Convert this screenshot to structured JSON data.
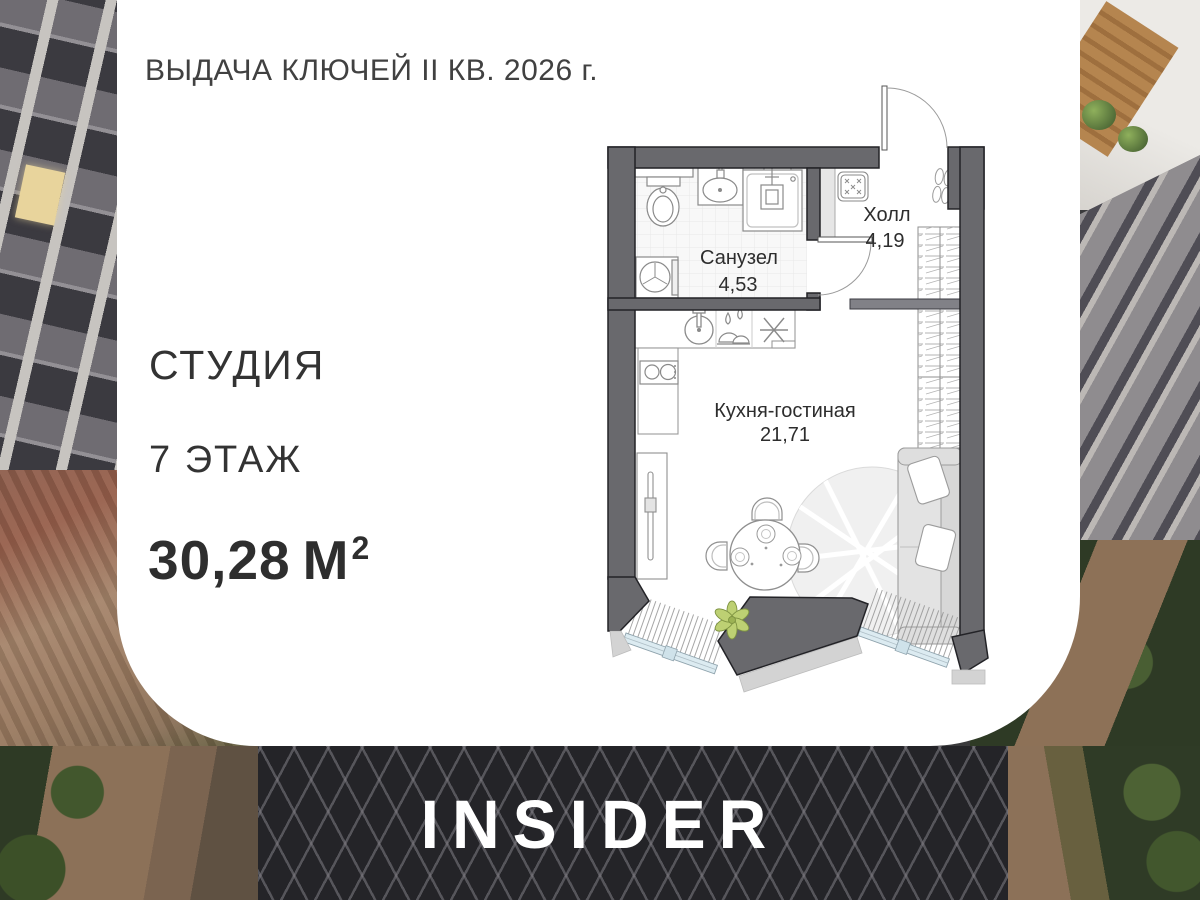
{
  "header": {
    "title": "ВЫДАЧА КЛЮЧЕЙ II КВ. 2026 г."
  },
  "listing": {
    "type": "СТУДИЯ",
    "floor": "7 ЭТАЖ",
    "area": "30,28",
    "area_unit": "М",
    "area_superscript": "2"
  },
  "floorplan": {
    "rooms": [
      {
        "name": "Санузел",
        "area": "4,53"
      },
      {
        "name": "Холл",
        "area": "4,19"
      },
      {
        "name": "Кухня-гостиная",
        "area": "21,71"
      }
    ],
    "icons": [
      "toilet-icon",
      "bathroom-sink-icon",
      "shower-icon",
      "washing-machine-icon",
      "kitchen-sink-icon",
      "dishwasher-icon",
      "hob-icon",
      "stove-icon",
      "doormat-icon",
      "shoes-icon",
      "wardrobe-hangers-icon",
      "sofa",
      "dining-table",
      "chairs",
      "rug",
      "tv-console",
      "plant-icon",
      "entrance-door",
      "bathroom-door",
      "window-glazing"
    ]
  },
  "footer": {
    "logo": "INSIDER"
  },
  "colors": {
    "card": "#ffffff",
    "wall": "#69696d",
    "glazing": "#dcebf1",
    "plant": "#bdd073",
    "text": "#333333",
    "logo": "#ffffff"
  }
}
